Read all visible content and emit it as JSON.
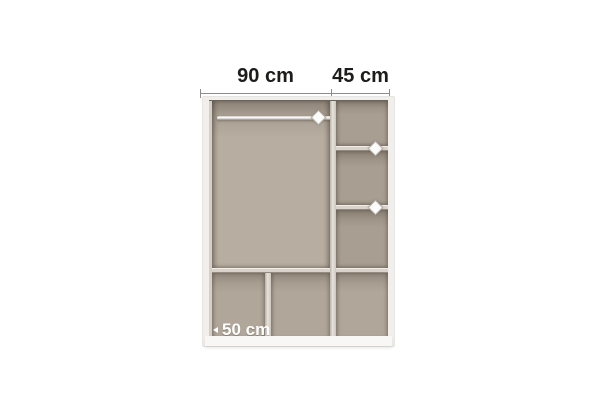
{
  "diagram": {
    "dimensions": {
      "left_section_width": "90 cm",
      "right_section_width": "45 cm",
      "bottom_compartment_width": "50 cm"
    },
    "icons": {
      "hanging_rail": "hanging-rail-icon",
      "rail_mount_pin": "diamond-pin-icon",
      "shelf_pin": "diamond-pin-icon",
      "depth_arrow": "arrow-left-icon"
    },
    "colors": {
      "background": "#ffffff",
      "frame_white": "#f1efec",
      "interior_taupe_light": "#b7ada0",
      "interior_taupe_dark": "#a89e91",
      "divider_light": "#d9d3cb",
      "dimension_text": "#1d1c1a",
      "dimension_line": "#8d8d8d",
      "bottom_label_text": "#ffffff"
    }
  }
}
